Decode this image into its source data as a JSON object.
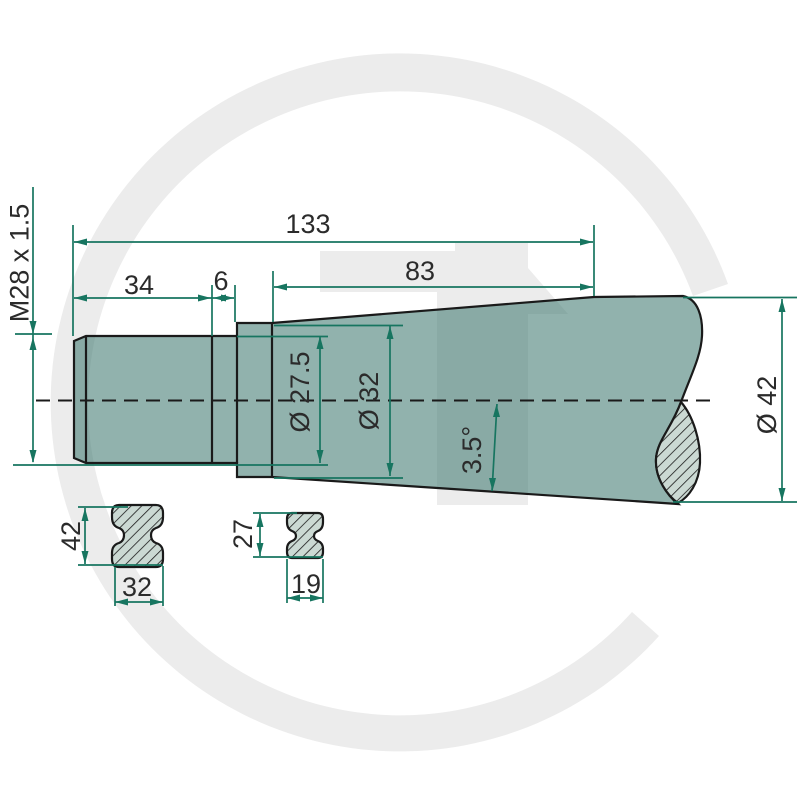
{
  "drawing": {
    "title": "Tine technical drawing",
    "watermark": {
      "letter": "G"
    },
    "labels": {
      "thread": "M28 x 1.5",
      "total_length": "133",
      "thread_length": "34",
      "neck_length": "6",
      "body_length": "83",
      "neck_diameter": "Ø 27.5",
      "collar_diameter": "Ø 32",
      "taper_angle": "3.5°",
      "body_diameter": "Ø 42",
      "section_large_height": "42",
      "section_large_width": "32",
      "section_small_height": "27",
      "section_small_width": "19"
    },
    "colors": {
      "dimension_green": "#177560",
      "outline_black": "#1a1a1a",
      "part_fill_teal": "#92b2ac",
      "hatch_fill": "#cbd9d3",
      "watermark_gray": "#ececec",
      "text": "#2b2b2b",
      "background": "#ffffff"
    }
  }
}
